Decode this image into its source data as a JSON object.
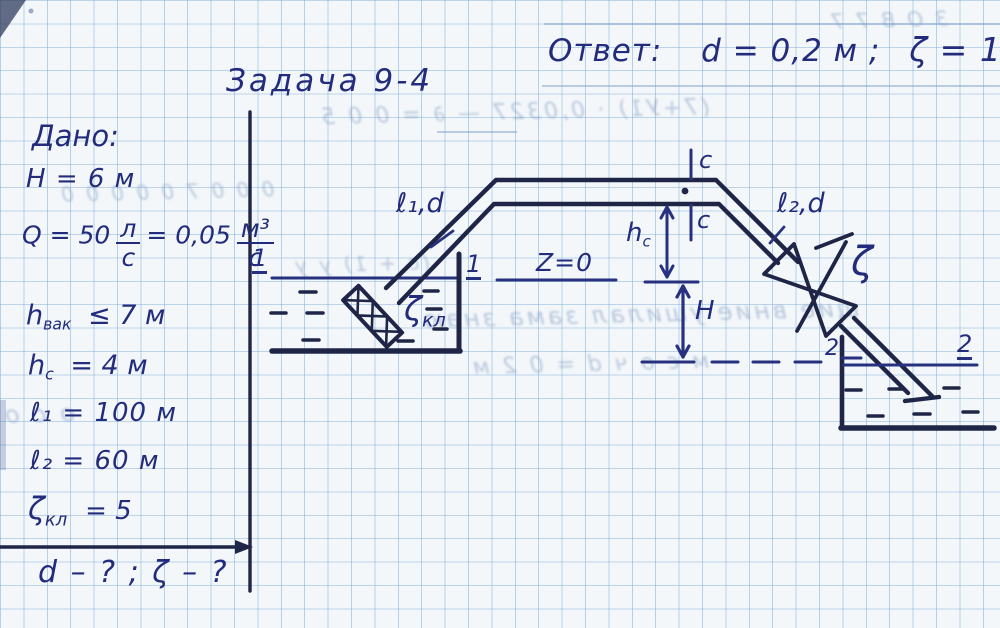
{
  "header": {
    "answer_label": "Ответ:",
    "answer_value_d": "d = 0,2 м ;",
    "answer_value_zeta": "ζ = 13",
    "title": "Задача 9-4"
  },
  "given": {
    "heading": "Дано:",
    "H": "H = 6 м",
    "Q_lhs": "Q = 50",
    "Q_num1": "л",
    "Q_den1": "с",
    "Q_mid": "= 0,05",
    "Q_num2": "м³",
    "Q_den2": "с",
    "hvak_base": "h",
    "hvak_sub": "вак",
    "hvak_rest": "≤ 7 м",
    "hc_base": "h",
    "hc_sub": "c",
    "hc_rest": "= 4 м",
    "l1": "ℓ₁ = 100 м",
    "l2": "ℓ₂ = 60 м",
    "zkl_base": "ζ",
    "zkl_sub": "кл",
    "zkl_rest": "= 5",
    "find": "d – ? ;  ζ – ?"
  },
  "diagram": {
    "l1d": "ℓ₁,d",
    "l2d": "ℓ₂,d",
    "z0": "Z=0",
    "hc_base": "h",
    "hc_sub": "c",
    "H": "H",
    "zeta": "ζ",
    "zkl_base": "ζ",
    "zkl_sub": "кл",
    "sec1": "1",
    "sec2": "2",
    "secc": "c"
  },
  "ghosts": [
    "(7+У1) · 0,0327 — ∂ = 0 0 5",
    "З О В   7 7",
    "0 0 0   7 0 0   0 0 0",
    "щие вние ушилал    зама знаю",
    "м с о ч     d = 0 2 м",
    "(с + 1) у у",
    "о с о"
  ],
  "colors": {
    "pen_blue": "#27317f",
    "ink_dark": "#1f2547",
    "grid_blue": "#7aaad6",
    "paper": "#f3f7fa"
  }
}
